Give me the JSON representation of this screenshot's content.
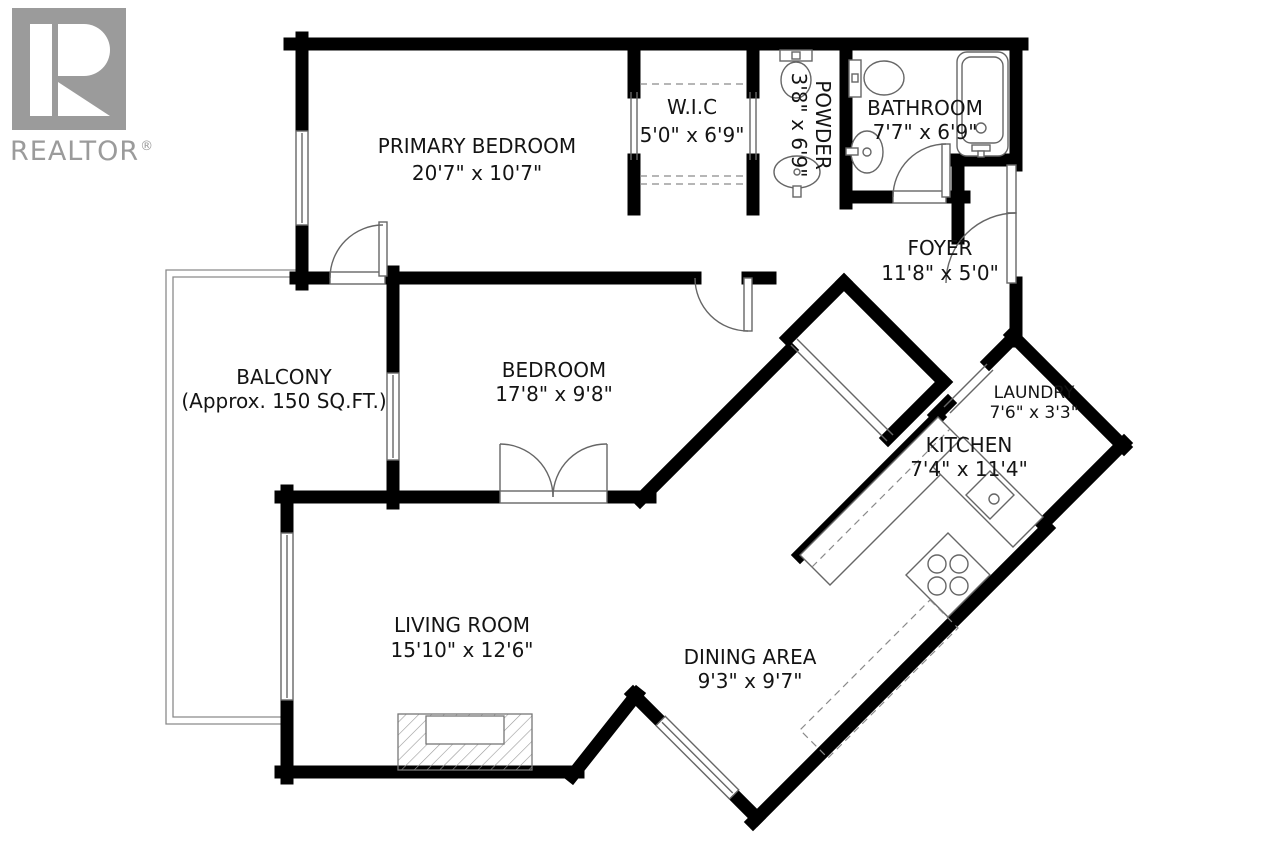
{
  "logo": {
    "brand": "REALTOR",
    "registered": "®"
  },
  "rooms": {
    "primary_bedroom": {
      "name": "PRIMARY BEDROOM",
      "dims": "20'7\" x 10'7\""
    },
    "wic": {
      "name": "W.I.C",
      "dims": "5'0\" x 6'9\""
    },
    "powder": {
      "name": "POWDER",
      "dims": "3'8\" x 6'9\""
    },
    "bathroom": {
      "name": "BATHROOM",
      "dims": "7'7\" x 6'9\""
    },
    "foyer": {
      "name": "FOYER",
      "dims": "11'8\" x 5'0\""
    },
    "balcony": {
      "name": "BALCONY",
      "dims": "(Approx. 150 SQ.FT.)"
    },
    "bedroom": {
      "name": "BEDROOM",
      "dims": "17'8\" x 9'8\""
    },
    "laundry": {
      "name": "LAUNDRY",
      "dims": "7'6\" x 3'3\""
    },
    "kitchen": {
      "name": "KITCHEN",
      "dims": "7'4\" x 11'4\""
    },
    "living_room": {
      "name": "LIVING ROOM",
      "dims": "15'10\" x 12'6\""
    },
    "dining_area": {
      "name": "DINING AREA",
      "dims": "9'3\" x 9'7\""
    }
  },
  "colors": {
    "wall": "#000000",
    "fixture_line": "#666666",
    "logo_gray": "#9b9b9b",
    "background": "#ffffff"
  }
}
